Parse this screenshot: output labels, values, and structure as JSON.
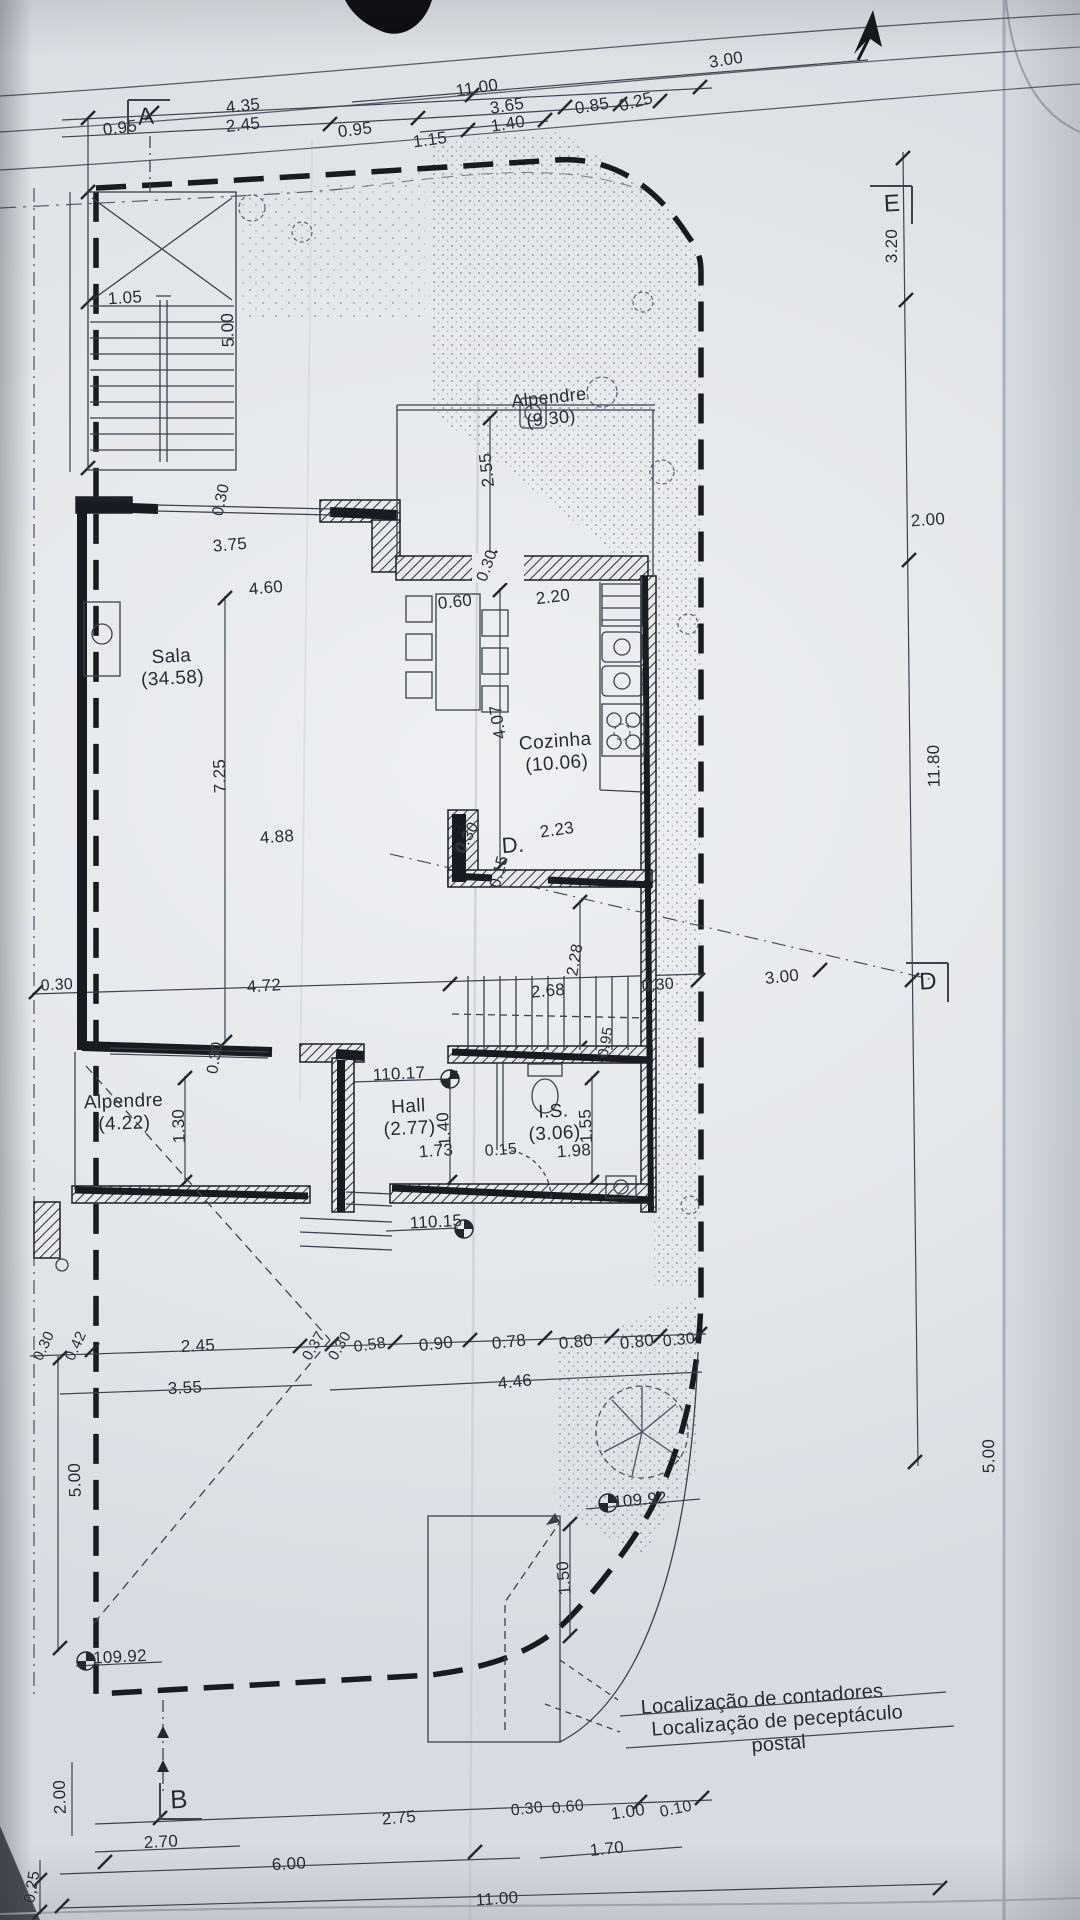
{
  "plan": {
    "notes": {
      "line1": "Localização de contadores",
      "line2": "Localização de peceptáculo postal"
    },
    "rooms": [
      {
        "name": "Sala",
        "area": "(34.58)"
      },
      {
        "name": "Cozinha",
        "area": "(10.06)"
      },
      {
        "name": "Alpendre",
        "area": "(9.30)"
      },
      {
        "name": "Alpendre",
        "area": "(4.22)"
      },
      {
        "name": "Hall",
        "area": "(2.77)"
      },
      {
        "name": "I.S.",
        "area": "(3.06)"
      }
    ],
    "levels": [
      "110.17",
      "110.15",
      "109.92",
      "109.92"
    ],
    "section_markers": [
      "A",
      "B",
      "D",
      "E",
      "D."
    ],
    "labels": [
      {
        "t": "11.00",
        "x": 477,
        "y": 88,
        "r": -9,
        "s": 17,
        "k": "dim"
      },
      {
        "t": "3.00",
        "x": 726,
        "y": 60,
        "r": -9,
        "s": 17,
        "k": "dim"
      },
      {
        "t": "3.65",
        "x": 507,
        "y": 106,
        "r": -9,
        "s": 17,
        "k": "dim"
      },
      {
        "t": "0.85",
        "x": 592,
        "y": 106,
        "r": -9,
        "s": 17,
        "k": "dim"
      },
      {
        "t": "0.25",
        "x": 636,
        "y": 102,
        "r": -15,
        "s": 17,
        "k": "dim"
      },
      {
        "t": "1.40",
        "x": 508,
        "y": 124,
        "r": -9,
        "s": 17,
        "k": "dim"
      },
      {
        "t": "0.95",
        "x": 120,
        "y": 128,
        "r": -7,
        "s": 17,
        "k": "dim"
      },
      {
        "t": "4.35",
        "x": 243,
        "y": 106,
        "r": -6,
        "s": 17,
        "k": "dim"
      },
      {
        "t": "2.45",
        "x": 243,
        "y": 125,
        "r": -6,
        "s": 17,
        "k": "dim"
      },
      {
        "t": "0.95",
        "x": 355,
        "y": 130,
        "r": -7,
        "s": 17,
        "k": "dim"
      },
      {
        "t": "1.15",
        "x": 430,
        "y": 140,
        "r": -8,
        "s": 17,
        "k": "dim"
      },
      {
        "t": "1.05",
        "x": 125,
        "y": 298,
        "r": -4,
        "s": 17,
        "k": "dim"
      },
      {
        "t": "5.00",
        "x": 228,
        "y": 330,
        "r": -92,
        "s": 17,
        "k": "dim"
      },
      {
        "t": "2.55",
        "x": 487,
        "y": 470,
        "r": -96,
        "s": 17,
        "k": "dim"
      },
      {
        "t": "0.30",
        "x": 222,
        "y": 500,
        "r": -78,
        "s": 16,
        "k": "dim"
      },
      {
        "t": "3.75",
        "x": 230,
        "y": 545,
        "r": -5,
        "s": 17,
        "k": "dim"
      },
      {
        "t": "4.60",
        "x": 266,
        "y": 588,
        "r": -5,
        "s": 17,
        "k": "dim"
      },
      {
        "t": "0.60",
        "x": 455,
        "y": 602,
        "r": -6,
        "s": 17,
        "k": "dim"
      },
      {
        "t": "2.20",
        "x": 553,
        "y": 597,
        "r": -7,
        "s": 17,
        "k": "dim"
      },
      {
        "t": "0.30",
        "x": 488,
        "y": 566,
        "r": -70,
        "s": 16,
        "k": "dim"
      },
      {
        "t": "4.07",
        "x": 498,
        "y": 722,
        "r": -99,
        "s": 17,
        "k": "dim"
      },
      {
        "t": "7.25",
        "x": 220,
        "y": 776,
        "r": -92,
        "s": 17,
        "k": "dim"
      },
      {
        "t": "4.88",
        "x": 277,
        "y": 837,
        "r": -4,
        "s": 17,
        "k": "dim"
      },
      {
        "t": "0.30",
        "x": 468,
        "y": 838,
        "r": -62,
        "s": 16,
        "k": "dim"
      },
      {
        "t": "2.23",
        "x": 557,
        "y": 830,
        "r": -8,
        "s": 17,
        "k": "dim"
      },
      {
        "t": "0.15",
        "x": 500,
        "y": 872,
        "r": -75,
        "s": 16,
        "k": "dim"
      },
      {
        "t": "2.28",
        "x": 576,
        "y": 960,
        "r": -80,
        "s": 16,
        "k": "dim"
      },
      {
        "t": "0.30",
        "x": 57,
        "y": 986,
        "r": -3,
        "s": 16,
        "k": "dim"
      },
      {
        "t": "4.72",
        "x": 264,
        "y": 986,
        "r": -4,
        "s": 17,
        "k": "dim"
      },
      {
        "t": "2.68",
        "x": 548,
        "y": 991,
        "r": -5,
        "s": 17,
        "k": "dim"
      },
      {
        "t": "0.30",
        "x": 658,
        "y": 986,
        "r": -5,
        "s": 16,
        "k": "dim"
      },
      {
        "t": "3.00",
        "x": 782,
        "y": 977,
        "r": -6,
        "s": 17,
        "k": "dim"
      },
      {
        "t": "0.30",
        "x": 216,
        "y": 1058,
        "r": -80,
        "s": 16,
        "k": "dim"
      },
      {
        "t": "110.17",
        "x": 399,
        "y": 1074,
        "r": -3,
        "s": 17,
        "k": "level"
      },
      {
        "t": "1.30",
        "x": 179,
        "y": 1126,
        "r": -92,
        "s": 17,
        "k": "dim"
      },
      {
        "t": "1.40",
        "x": 444,
        "y": 1129,
        "r": -95,
        "s": 17,
        "k": "dim"
      },
      {
        "t": "1.55",
        "x": 586,
        "y": 1126,
        "r": -93,
        "s": 17,
        "k": "dim"
      },
      {
        "t": "0.95",
        "x": 606,
        "y": 1042,
        "r": -80,
        "s": 15,
        "k": "dim"
      },
      {
        "t": "1.73",
        "x": 436,
        "y": 1151,
        "r": -4,
        "s": 17,
        "k": "dim"
      },
      {
        "t": "0.15",
        "x": 501,
        "y": 1151,
        "r": -4,
        "s": 16,
        "k": "dim"
      },
      {
        "t": "1.98",
        "x": 574,
        "y": 1151,
        "r": -4,
        "s": 17,
        "k": "dim"
      },
      {
        "t": "110.15",
        "x": 436,
        "y": 1222,
        "r": -3,
        "s": 17,
        "k": "level"
      },
      {
        "t": "0.30",
        "x": 44,
        "y": 1346,
        "r": -65,
        "s": 15,
        "k": "dim"
      },
      {
        "t": "0.42",
        "x": 76,
        "y": 1346,
        "r": -65,
        "s": 15,
        "k": "dim"
      },
      {
        "t": "2.45",
        "x": 198,
        "y": 1346,
        "r": -3,
        "s": 17,
        "k": "dim"
      },
      {
        "t": "0.37",
        "x": 314,
        "y": 1346,
        "r": -60,
        "s": 15,
        "k": "dim"
      },
      {
        "t": "0.30",
        "x": 340,
        "y": 1346,
        "r": -60,
        "s": 15,
        "k": "dim"
      },
      {
        "t": "0.58",
        "x": 370,
        "y": 1346,
        "r": -8,
        "s": 16,
        "k": "dim"
      },
      {
        "t": "0.90",
        "x": 436,
        "y": 1344,
        "r": -6,
        "s": 17,
        "k": "dim"
      },
      {
        "t": "0.78",
        "x": 509,
        "y": 1342,
        "r": -6,
        "s": 17,
        "k": "dim"
      },
      {
        "t": "0.80",
        "x": 576,
        "y": 1342,
        "r": -6,
        "s": 17,
        "k": "dim"
      },
      {
        "t": "0.80",
        "x": 637,
        "y": 1342,
        "r": -6,
        "s": 17,
        "k": "dim"
      },
      {
        "t": "0.30",
        "x": 679,
        "y": 1341,
        "r": -6,
        "s": 16,
        "k": "dim"
      },
      {
        "t": "3.55",
        "x": 185,
        "y": 1388,
        "r": -3,
        "s": 17,
        "k": "dim"
      },
      {
        "t": "4.46",
        "x": 515,
        "y": 1382,
        "r": -6,
        "s": 17,
        "k": "dim"
      },
      {
        "t": "5.00",
        "x": 75,
        "y": 1480,
        "r": -92,
        "s": 17,
        "k": "dim"
      },
      {
        "t": "109.92",
        "x": 640,
        "y": 1500,
        "r": -5,
        "s": 17,
        "k": "level"
      },
      {
        "t": "1.50",
        "x": 564,
        "y": 1578,
        "r": -95,
        "s": 17,
        "k": "dim"
      },
      {
        "t": "109.92",
        "x": 120,
        "y": 1657,
        "r": -3,
        "s": 17,
        "k": "level"
      },
      {
        "t": "2.00",
        "x": 60,
        "y": 1797,
        "r": -92,
        "s": 17,
        "k": "dim"
      },
      {
        "t": "2.75",
        "x": 399,
        "y": 1818,
        "r": -5,
        "s": 17,
        "k": "dim"
      },
      {
        "t": "0.30",
        "x": 527,
        "y": 1810,
        "r": -6,
        "s": 16,
        "k": "dim"
      },
      {
        "t": "0.60",
        "x": 568,
        "y": 1808,
        "r": -6,
        "s": 16,
        "k": "dim"
      },
      {
        "t": "1.00",
        "x": 628,
        "y": 1812,
        "r": -8,
        "s": 17,
        "k": "dim"
      },
      {
        "t": "0.10",
        "x": 676,
        "y": 1810,
        "r": -12,
        "s": 16,
        "k": "dim"
      },
      {
        "t": "2.70",
        "x": 161,
        "y": 1842,
        "r": -3,
        "s": 17,
        "k": "dim"
      },
      {
        "t": "1.70",
        "x": 607,
        "y": 1849,
        "r": -6,
        "s": 17,
        "k": "dim"
      },
      {
        "t": "6.00",
        "x": 289,
        "y": 1864,
        "r": -3,
        "s": 17,
        "k": "dim"
      },
      {
        "t": "0,25",
        "x": 33,
        "y": 1887,
        "r": -80,
        "s": 16,
        "k": "dim"
      },
      {
        "t": "11.00",
        "x": 497,
        "y": 1899,
        "r": -4,
        "s": 17,
        "k": "dim"
      },
      {
        "t": "3.20",
        "x": 892,
        "y": 246,
        "r": -90,
        "s": 17,
        "k": "dim"
      },
      {
        "t": "2.00",
        "x": 928,
        "y": 520,
        "r": -4,
        "s": 17,
        "k": "dim"
      },
      {
        "t": "11.80",
        "x": 934,
        "y": 766,
        "r": -91,
        "s": 17,
        "k": "dim"
      },
      {
        "t": "5.00",
        "x": 989,
        "y": 1456,
        "r": -91,
        "s": 17,
        "k": "dim"
      },
      {
        "t": "E",
        "x": 892,
        "y": 204,
        "r": -3,
        "s": 24,
        "k": "marker"
      },
      {
        "t": "A",
        "x": 146,
        "y": 117,
        "r": -4,
        "s": 24,
        "k": "marker"
      },
      {
        "t": "B",
        "x": 179,
        "y": 1800,
        "r": -3,
        "s": 26,
        "k": "marker"
      },
      {
        "t": "D",
        "x": 928,
        "y": 982,
        "r": -3,
        "s": 24,
        "k": "marker"
      },
      {
        "t": "D.",
        "x": 513,
        "y": 845,
        "r": -4,
        "s": 22,
        "k": "marker"
      },
      {
        "t": "Sala\n(34.58)",
        "x": 172,
        "y": 668,
        "r": -3,
        "s": 19,
        "k": "room"
      },
      {
        "t": "Cozinha\n(10.06)",
        "x": 556,
        "y": 753,
        "r": -4,
        "s": 19,
        "k": "room"
      },
      {
        "t": "Alpendre\n(9.30)",
        "x": 550,
        "y": 408,
        "r": -6,
        "s": 18,
        "k": "room"
      },
      {
        "t": "Alpendre\n(4.22)",
        "x": 124,
        "y": 1113,
        "r": -2,
        "s": 19,
        "k": "room"
      },
      {
        "t": "Hall\n(2.77)",
        "x": 409,
        "y": 1118,
        "r": -3,
        "s": 19,
        "k": "room"
      },
      {
        "t": "I.S.\n(3.06)",
        "x": 554,
        "y": 1123,
        "r": -3,
        "s": 19,
        "k": "room"
      },
      {
        "t": "Localização de contadores",
        "x": 762,
        "y": 1700,
        "r": -4,
        "s": 20,
        "k": "note"
      },
      {
        "t": "Localização de peceptáculo postal",
        "x": 778,
        "y": 1733,
        "r": -4,
        "s": 20,
        "k": "note"
      }
    ]
  }
}
